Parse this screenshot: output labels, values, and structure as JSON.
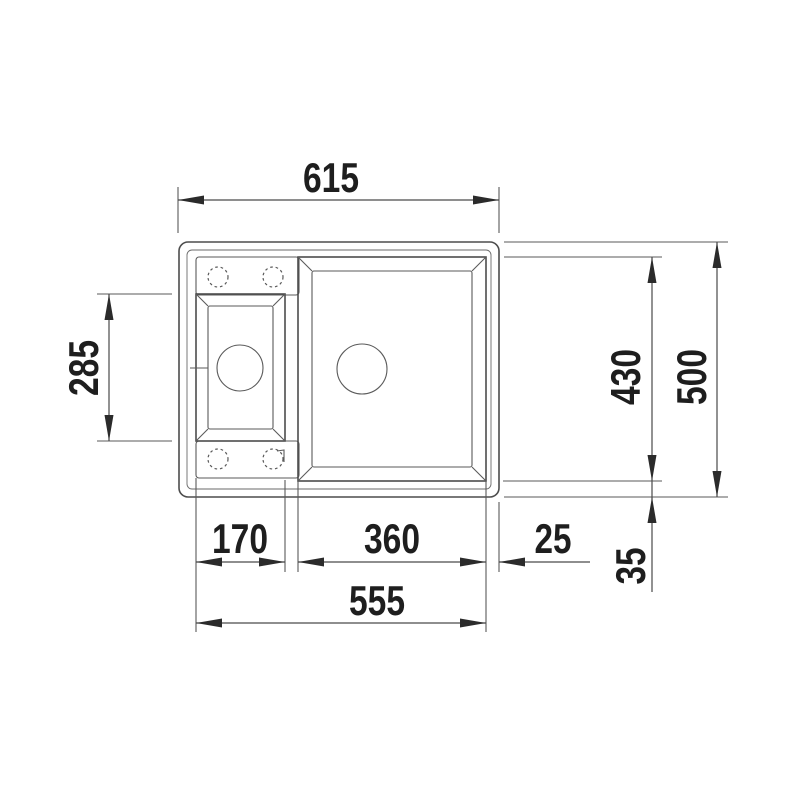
{
  "drawing_title": "sink-top-view-technical-drawing",
  "colors": {
    "background": "#ffffff",
    "line": "#4d4d4d",
    "dimension_text": "#1e1e1e"
  },
  "dimensions": {
    "overall_width": "615",
    "small_bowl_height": "285",
    "bowl_height": "430",
    "overall_depth": "500",
    "small_bowl_width": "170",
    "main_bowl_width": "360",
    "right_inset": "25",
    "bowls_span": "555",
    "bottom_inset": "35"
  },
  "chart_data": {
    "type": "table",
    "title": "Sink dimensions (mm)",
    "values": {
      "overall_width": 615,
      "overall_depth": 500,
      "bowl_height": 430,
      "small_bowl_height": 285,
      "small_bowl_width": 170,
      "main_bowl_width": 360,
      "right_inset": 25,
      "bottom_inset": 35,
      "bowls_span": 555
    }
  }
}
